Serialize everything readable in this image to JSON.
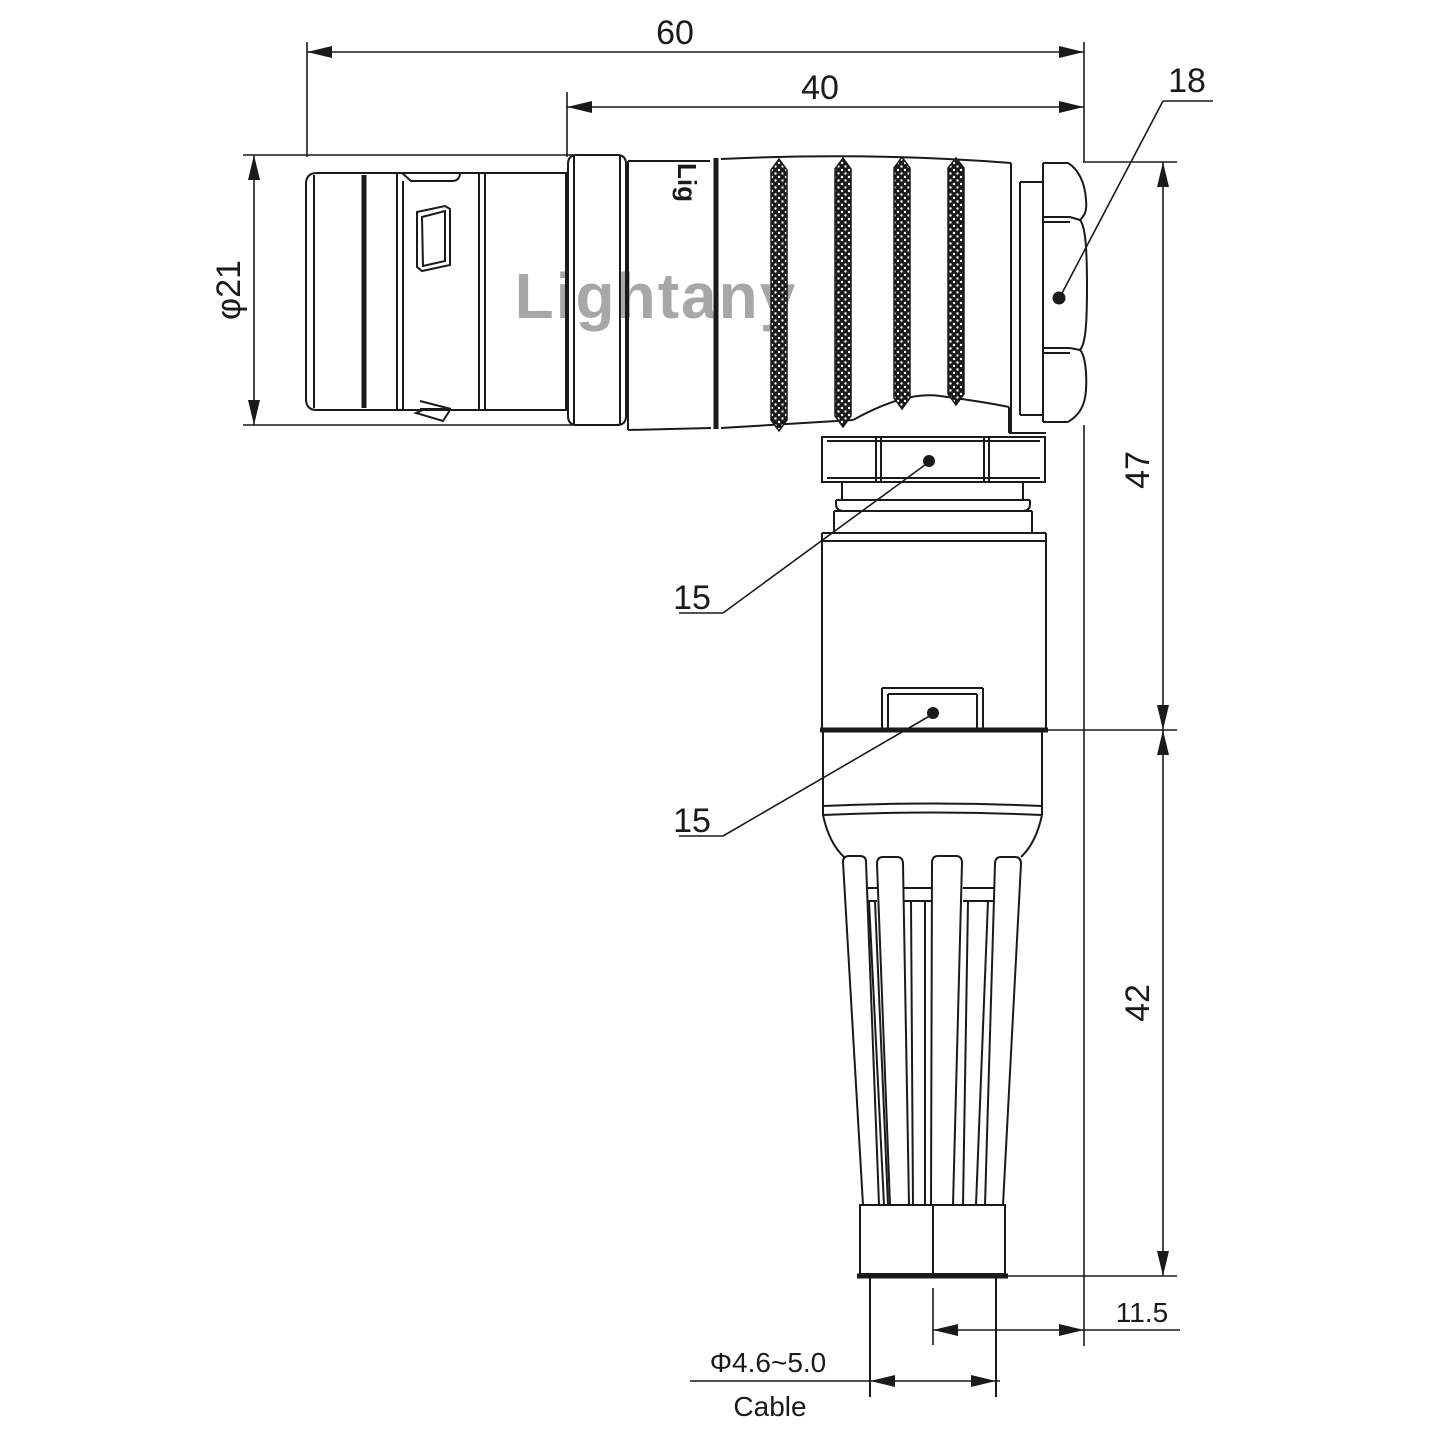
{
  "drawing": {
    "watermark": {
      "text": "Lightany",
      "color": "#dd8890"
    },
    "body_marking": {
      "text": "Lig"
    },
    "line_color": "#1a1a1a",
    "dims": {
      "overall_length": "60",
      "rear_length": "40",
      "front_diameter": "φ21",
      "nut_across_flats": "18",
      "upper_height": "47",
      "lower_height": "42",
      "coupling_nut_flats": "15",
      "body_flats": "15",
      "cable_offset": "11.5",
      "cable_diameter": "Φ4.6~5.0",
      "cable_label": "Cable"
    }
  }
}
